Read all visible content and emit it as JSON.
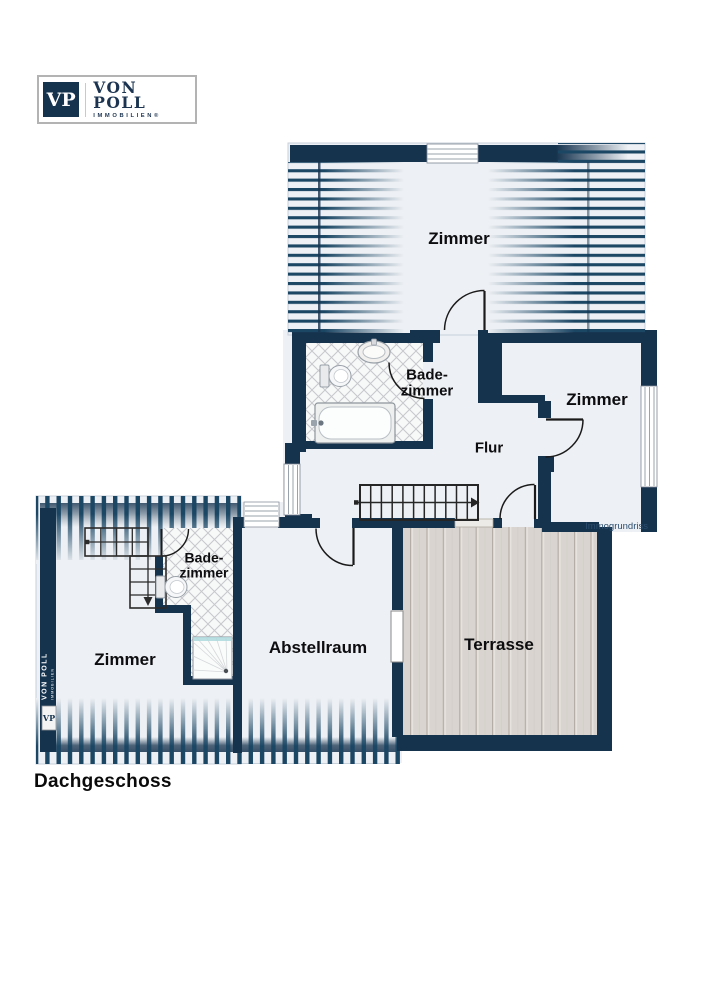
{
  "logo": {
    "vp": "VP",
    "name": "VON POLL",
    "sub": "IMMOBILIEN®"
  },
  "rooms": {
    "zimmer_top": "Zimmer",
    "bad_top_line1": "Bade-",
    "bad_top_line2": "zimmer",
    "flur": "Flur",
    "zimmer_right": "Zimmer",
    "zimmer_left": "Zimmer",
    "bad_left_line1": "Bade-",
    "bad_left_line2": "zimmer",
    "abstellraum": "Abstellraum",
    "terrasse": "Terrasse"
  },
  "floor": {
    "title": "Dachgeschoss"
  },
  "credit": "Immogrundriss",
  "watermark": {
    "vp": "VP",
    "name": "VON POLL",
    "sub": "IMMOBILIEN"
  },
  "colors": {
    "wall": "#16334e",
    "stripe": "#1b4765",
    "interior": "#edf0f4",
    "terrace": "#d9d4cf",
    "tile_line": "#c6c8cc",
    "shower_accent": "#aed9dd"
  }
}
